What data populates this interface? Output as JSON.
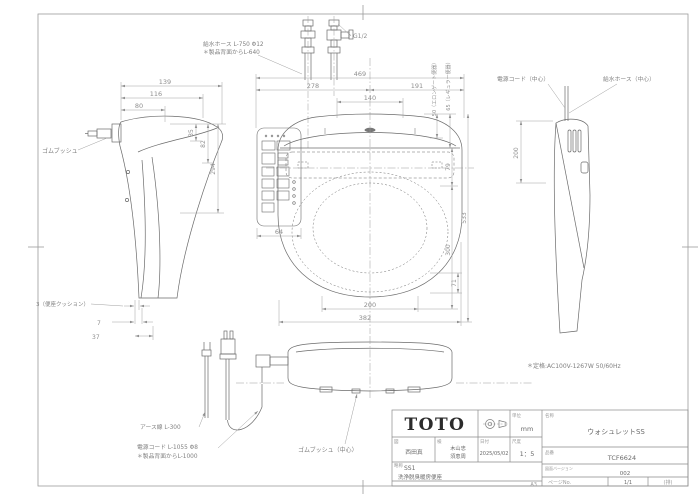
{
  "drawing": {
    "labels": {
      "hose_top_1": "給水ホース L-750 Φ12",
      "hose_top_2": "＊製品背面からL-640",
      "g_thread": "G1/2",
      "rubber_bush": "ゴムブッシュ",
      "seat_cushion": "3（便座クッション）",
      "power_cord_center": "電源コード（中心）",
      "hose_center": "給水ホース（中心）",
      "earth_wire": "アース線 L-300",
      "power_cord_1": "電源コード L-1055 Φ8",
      "power_cord_2": "＊製品背面からL-1000",
      "rubber_bush_center": "ゴムブッシュ（中心）",
      "rating": "＊定格:AC100V-1267W 50/60Hz"
    },
    "dims": {
      "w139": "139",
      "w116": "116",
      "w80": "80",
      "h35": "35",
      "h82": "82",
      "h294": "294",
      "b7": "7",
      "b37": "37",
      "t469": "469",
      "t278": "278",
      "t191": "191",
      "t140": "140",
      "e50": "50（エロンゲート便器）",
      "e65": "65（レギュラー便器）",
      "v79": "79",
      "v300": "300",
      "v533": "533",
      "p64": "64",
      "v71": "71",
      "b200": "200",
      "b382": "382",
      "r200": "200"
    }
  },
  "title": {
    "brand": "TOTO",
    "unit_label": "単位",
    "unit_value": "mm",
    "drafter_label": "図",
    "drafter": "西田真",
    "checker_label": "検",
    "checker1": "木山忠",
    "checker2": "須恵周",
    "date_label": "日付",
    "date": "2025/05/02",
    "scale_label": "尺度",
    "scale": "1：5",
    "series_label": "略称",
    "series": "SS1",
    "category": "洗浄脱臭暖房便座",
    "name_label": "名称",
    "name": "ウォシュレットSS",
    "number_label": "品番",
    "number": "TCF6624",
    "version_label": "図面バージョン",
    "version": "002",
    "sheet": "A3",
    "page_label": "ページNo.",
    "page": "1/1",
    "page_note": "(排)"
  }
}
